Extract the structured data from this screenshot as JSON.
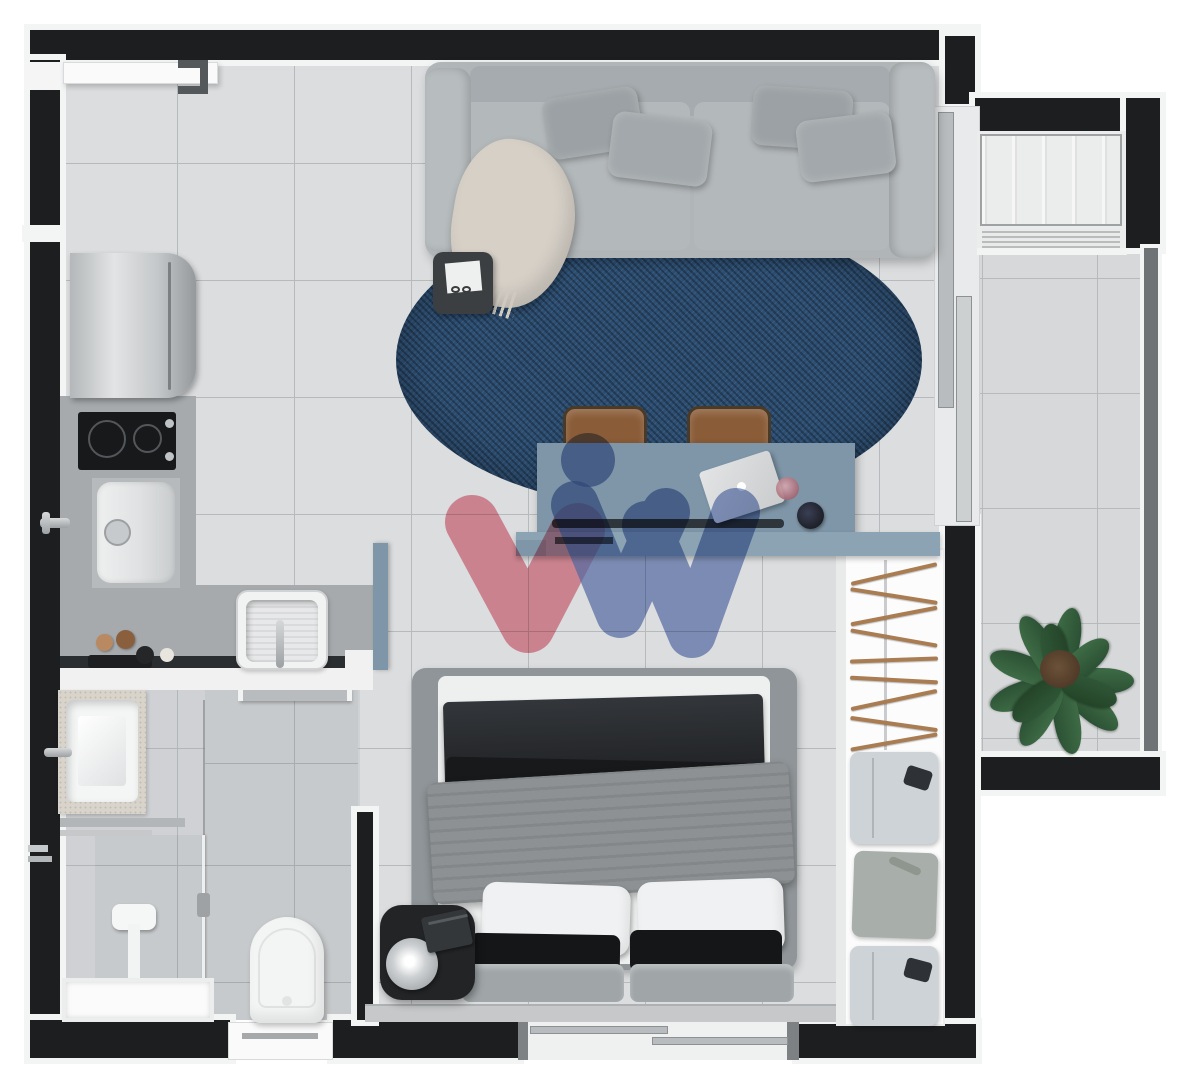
{
  "document": {
    "type": "apartment-floor-plan-render",
    "view": "top-down-3d",
    "visible_text": "none"
  },
  "colors": {
    "background": "#ffffff",
    "wall_black": "#1c1e20",
    "wall_trim_white": "#f3f4f4",
    "floor_tile": "#dbdddf",
    "floor_grout": "#b6babc",
    "shower_tile": "#c7cacc",
    "kitchen_counter": "#a6aaad",
    "desk_blue": "#7e96a8",
    "desk_shelf_blue": "#8ba3b3",
    "rug_blue": "#2c4e72",
    "sofa_gray": "#b0b5b7",
    "bed_duvet_dark": "#26282b",
    "bed_blanket_gray": "#8d9193",
    "chair_brown": "#8a5c38",
    "plant_green": "#3e6b45",
    "hanger_wood": "#a97c52",
    "watermark_pink": "#e8808f",
    "watermark_blue": "#6079b8",
    "railing_gray": "#6f7376"
  },
  "rooms": [
    {
      "name": "living-room",
      "furniture": [
        "sofa",
        "throw-blanket",
        "side-table",
        "round-rug",
        "desk",
        "two-chairs",
        "laptop",
        "cup",
        "speaker"
      ]
    },
    {
      "name": "kitchen",
      "furniture": [
        "refrigerator",
        "cooktop",
        "washer-column",
        "sink",
        "counter",
        "bottles-tray"
      ]
    },
    {
      "name": "bathroom",
      "furniture": [
        "vanity-sink",
        "wall-shelf",
        "shower-column",
        "glass-screen",
        "shower-tray",
        "toilet",
        "door"
      ]
    },
    {
      "name": "bedroom",
      "furniture": [
        "double-bed",
        "nightstand",
        "table-lamp",
        "book",
        "window"
      ]
    },
    {
      "name": "closet",
      "furniture": [
        "hanger-rods",
        "folded-shirts"
      ]
    },
    {
      "name": "balcony",
      "furniture": [
        "potted-plant",
        "ac-condenser-unit",
        "sliding-glass-door",
        "glass-railing"
      ]
    }
  ],
  "watermark": {
    "shape": "stylized-w-logo",
    "elements": [
      "pink-check",
      "blue-double-check",
      "blue-dot"
    ]
  }
}
